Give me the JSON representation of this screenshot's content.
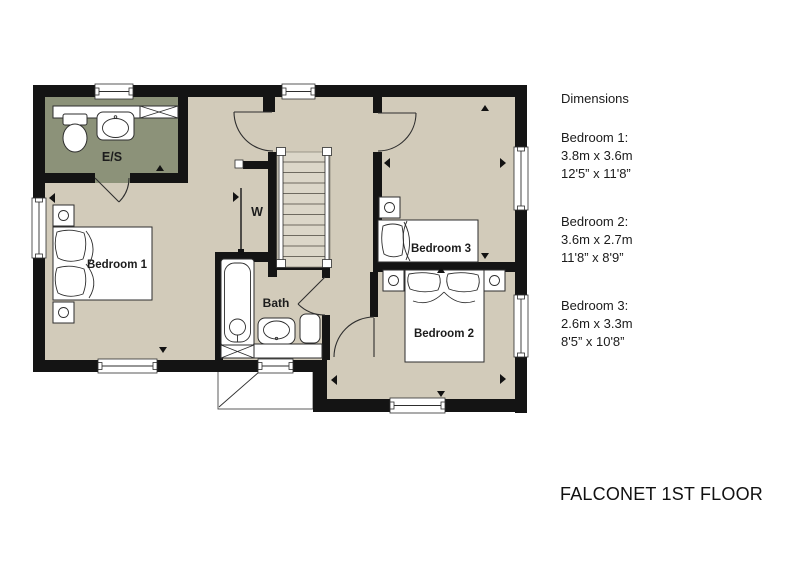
{
  "title": "FALCONET 1ST FLOOR",
  "panel": {
    "heading": "Dimensions",
    "rooms": [
      {
        "name": "Bedroom 1:",
        "metric": "3.8m x 3.6m",
        "imperial": "12'5” x 11'8”"
      },
      {
        "name": "Bedroom 2:",
        "metric": "3.6m x 2.7m",
        "imperial": "11'8” x 8'9”"
      },
      {
        "name": "Bedroom 3:",
        "metric": "2.6m x 3.3m",
        "imperial": "8'5” x 10'8”"
      }
    ]
  },
  "plan": {
    "labels": {
      "bedroom1": "Bedroom 1",
      "bedroom2": "Bedroom 2",
      "bedroom3": "Bedroom 3",
      "ensuite": "E/S",
      "bath": "Bath",
      "wardrobe": "W"
    },
    "colors": {
      "wall": "#141414",
      "floor": "#d2cbba",
      "ensuite": "#8c9279",
      "stairs": "#dcd7c9"
    }
  }
}
